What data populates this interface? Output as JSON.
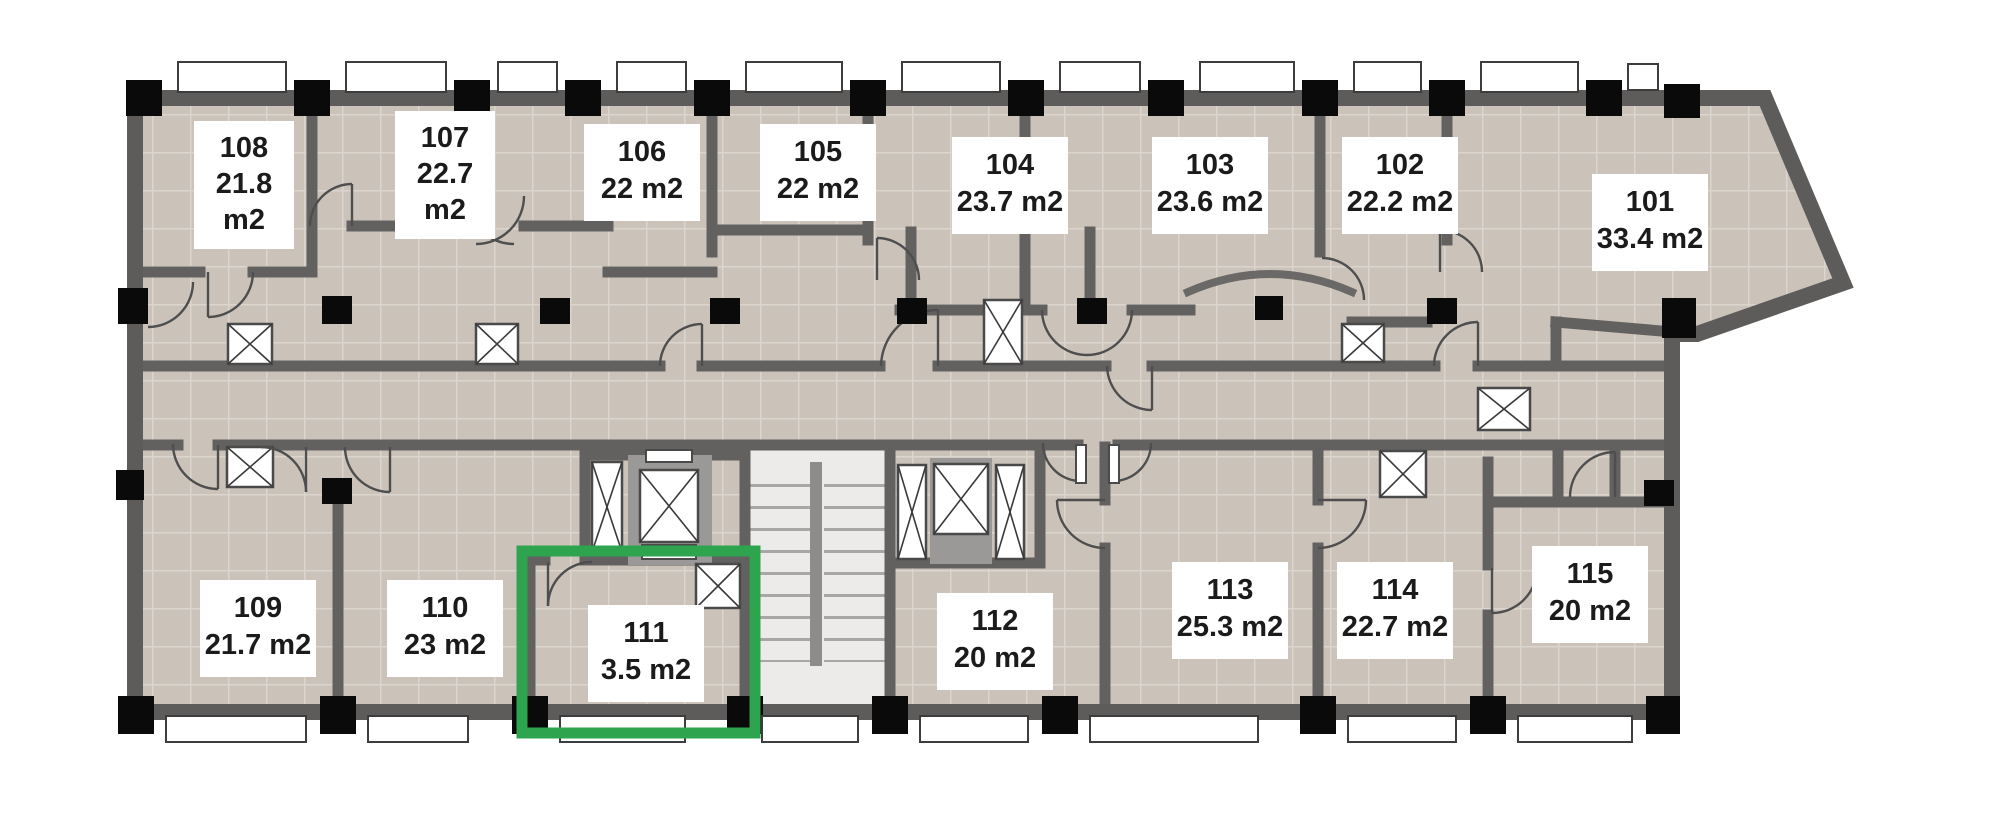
{
  "plan": {
    "type": "floor-plan",
    "highlight": {
      "room_number": "111",
      "color": "#2ea44e"
    },
    "colors": {
      "wall": "#5e5c5b",
      "column": "#0a0a0a",
      "floor_tile": "#cbc3ba",
      "tile_grout": "#dbd5ce",
      "stairs_floor": "#ecebe9",
      "elevator_core": "#9b9997",
      "highlight_green": "#2ea44e",
      "background": "#ffffff",
      "label_bg": "#ffffff",
      "label_text": "#1b1b1b"
    },
    "symbols": {
      "shaft_icon": "x-crossed-box",
      "stairs_icon": "stair-treads",
      "door_icon": "quarter-circle-swing",
      "column_icon": "filled-black-square",
      "window_icon": "white-sill-rectangle"
    }
  },
  "rooms": [
    {
      "number": "101",
      "area": "33.4 m2",
      "lines": [
        "101",
        "33.4 m2"
      ]
    },
    {
      "number": "102",
      "area": "22.2 m2",
      "lines": [
        "102",
        "22.2 m2"
      ]
    },
    {
      "number": "103",
      "area": "23.6 m2",
      "lines": [
        "103",
        "23.6 m2"
      ]
    },
    {
      "number": "104",
      "area": "23.7 m2",
      "lines": [
        "104",
        "23.7 m2"
      ]
    },
    {
      "number": "105",
      "area": "22 m2",
      "lines": [
        "105",
        "22 m2"
      ]
    },
    {
      "number": "106",
      "area": "22 m2",
      "lines": [
        "106",
        "22 m2"
      ]
    },
    {
      "number": "107",
      "area": "22.7 m2",
      "lines": [
        "107",
        "22.7",
        "m2"
      ]
    },
    {
      "number": "108",
      "area": "21.8 m2",
      "lines": [
        "108",
        "21.8",
        "m2"
      ]
    },
    {
      "number": "109",
      "area": "21.7 m2",
      "lines": [
        "109",
        "21.7 m2"
      ]
    },
    {
      "number": "110",
      "area": "23 m2",
      "lines": [
        "110",
        "23 m2"
      ]
    },
    {
      "number": "111",
      "area": "3.5 m2",
      "lines": [
        "111",
        "3.5 m2"
      ]
    },
    {
      "number": "112",
      "area": "20 m2",
      "lines": [
        "112",
        "20 m2"
      ]
    },
    {
      "number": "113",
      "area": "25.3 m2",
      "lines": [
        "113",
        "25.3 m2"
      ]
    },
    {
      "number": "114",
      "area": "22.7 m2",
      "lines": [
        "114",
        "22.7 m2"
      ]
    },
    {
      "number": "115",
      "area": "20 m2",
      "lines": [
        "115",
        "20 m2"
      ]
    }
  ]
}
